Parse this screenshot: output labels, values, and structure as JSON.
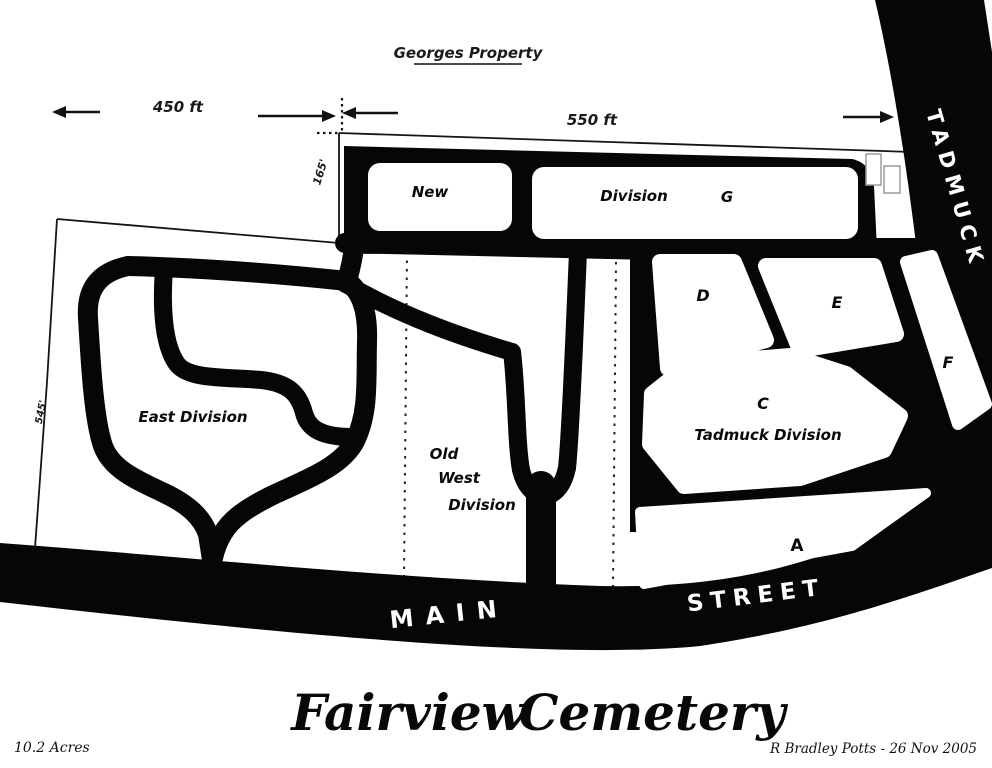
{
  "colors": {
    "ink": "#060606",
    "paper": "#ffffff",
    "building_outline": "#9a9a9a"
  },
  "header": {
    "property_label": "Georges Property"
  },
  "measurements": {
    "west_span": "450 ft",
    "east_span": "550 ft",
    "offset_width": "165'",
    "west_boundary_length": "545'"
  },
  "streets": {
    "main_word1": "MAIN",
    "main_word2": "STREET",
    "tadmuck": "TADMUCK"
  },
  "divisions": {
    "new_label": "New",
    "g_division_label": "Division",
    "g_letter": "G",
    "east": "East Division",
    "old_west_line1": "Old",
    "old_west_line2": "West",
    "old_west_line3": "Division",
    "tadmuck_letter": "C",
    "tadmuck_name": "Tadmuck Division",
    "d_letter": "D",
    "e_letter": "E",
    "f_letter": "F",
    "a_letter": "A"
  },
  "title": {
    "word1": "Fairview",
    "word2": "Cemetery"
  },
  "footer": {
    "acreage": "10.2 Acres",
    "credit": "R Bradley Potts - 26 Nov 2005"
  }
}
